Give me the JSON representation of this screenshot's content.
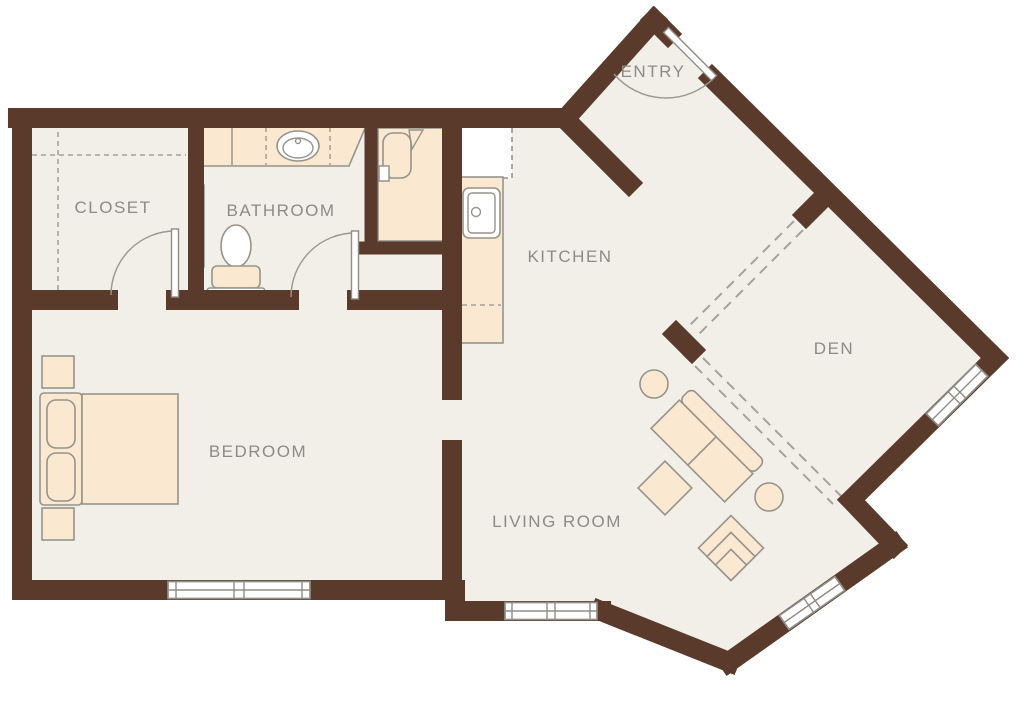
{
  "colors": {
    "wall": "#5a3b2b",
    "floor": "#f2efe9",
    "furniture_fill": "#fae8d1",
    "furniture_stroke": "#96948b",
    "label": "#8c8b85",
    "dash": "#a5a29a",
    "window_fill": "#ffffff",
    "background": "#ffffff"
  },
  "rooms": [
    {
      "id": "closet",
      "label": "CLOSET"
    },
    {
      "id": "bathroom",
      "label": "BATHROOM"
    },
    {
      "id": "kitchen",
      "label": "KITCHEN"
    },
    {
      "id": "entry",
      "label": "ENTRY"
    },
    {
      "id": "den",
      "label": "DEN"
    },
    {
      "id": "bedroom",
      "label": "BEDROOM"
    },
    {
      "id": "living-room",
      "label": "LIVING ROOM"
    }
  ],
  "fixtures": [
    "bed-with-pillows",
    "nightstand",
    "nightstand",
    "sofa",
    "ottoman",
    "armchair",
    "side-table",
    "side-table",
    "toilet",
    "vanity-sink",
    "shower-tub",
    "towel-bar",
    "kitchen-sink",
    "kitchen-counter",
    "refrigerator",
    "closet-shelving-dashed"
  ],
  "openings": {
    "doors": [
      "entry-door",
      "closet-door",
      "bathroom-door"
    ],
    "windows": [
      "bedroom-window",
      "living-room-window",
      "living-room-diagonal-window",
      "den-window"
    ],
    "cased_openings": [
      "den-northwest-opening",
      "den-southwest-opening",
      "bedroom-opening"
    ]
  }
}
